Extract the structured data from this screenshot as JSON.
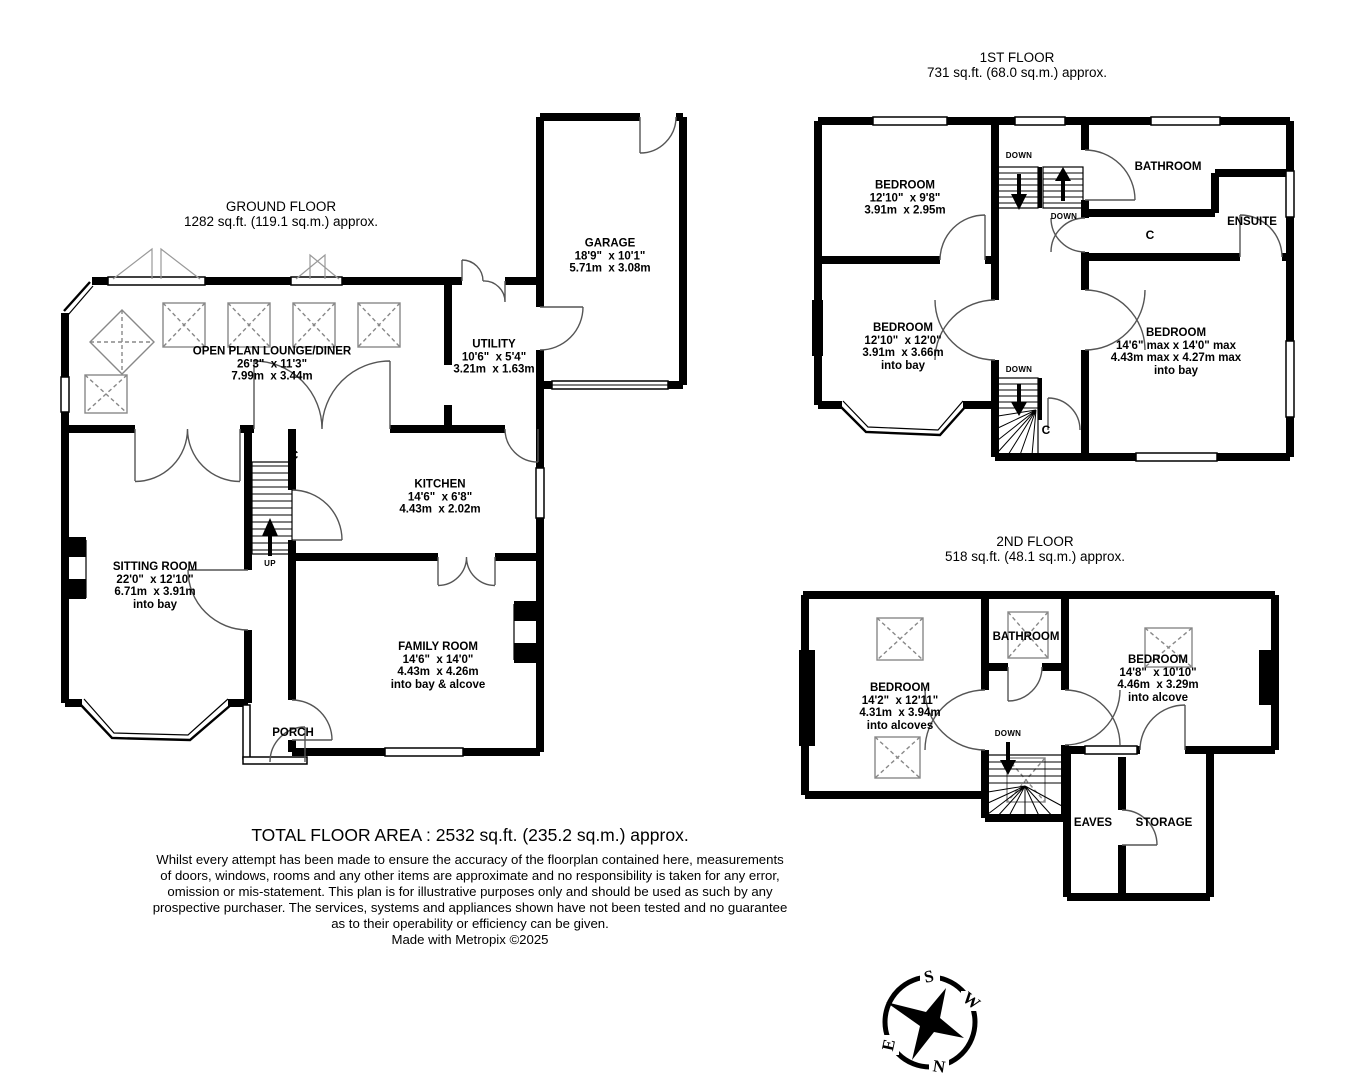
{
  "ground_floor": {
    "title": "GROUND FLOOR",
    "area": "1282 sq.ft. (119.1 sq.m.) approx.",
    "rooms": {
      "lounge": {
        "name": "OPEN PLAN LOUNGE/DINER",
        "imperial": "26'3\"  x 11'3\"",
        "metric": "7.99m  x 3.44m"
      },
      "utility": {
        "name": "UTILITY",
        "imperial": "10'6\"  x 5'4\"",
        "metric": "3.21m  x 1.63m"
      },
      "garage": {
        "name": "GARAGE",
        "imperial": "18'9\"  x 10'1\"",
        "metric": "5.71m  x 3.08m"
      },
      "kitchen": {
        "name": "KITCHEN",
        "imperial": "14'6\"  x 6'8\"",
        "metric": "4.43m  x 2.02m"
      },
      "sitting": {
        "name": "SITTING ROOM",
        "imperial": "22'0\"  x 12'10\"",
        "metric": "6.71m  x 3.91m",
        "note": "into bay"
      },
      "family": {
        "name": "FAMILY ROOM",
        "imperial": "14'6\"  x 14'0\"",
        "metric": "4.43m  x 4.26m",
        "note": "into bay & alcove"
      },
      "porch": {
        "name": "PORCH"
      }
    },
    "labels": {
      "up": "UP",
      "cupboard": "C"
    }
  },
  "first_floor": {
    "title": "1ST FLOOR",
    "area": "731 sq.ft. (68.0 sq.m.) approx.",
    "rooms": {
      "bedroom1": {
        "name": "BEDROOM",
        "imperial": "12'10\"  x 9'8\"",
        "metric": "3.91m  x 2.95m"
      },
      "bedroom2": {
        "name": "BEDROOM",
        "imperial": "12'10\"  x 12'0\"",
        "metric": "3.91m  x 3.66m",
        "note": "into bay"
      },
      "bedroom3": {
        "name": "BEDROOM",
        "imperial": "14'6\" max x 14'0\" max",
        "metric": "4.43m max x 4.27m max",
        "note": "into bay"
      },
      "bathroom": {
        "name": "BATHROOM"
      },
      "ensuite": {
        "name": "ENSUITE"
      }
    },
    "labels": {
      "down": "DOWN",
      "cupboard": "C"
    }
  },
  "second_floor": {
    "title": "2ND FLOOR",
    "area": "518 sq.ft. (48.1 sq.m.) approx.",
    "rooms": {
      "bedroom4": {
        "name": "BEDROOM",
        "imperial": "14'2\"  x 12'11\"",
        "metric": "4.31m  x 3.94m",
        "note": "into alcoves"
      },
      "bedroom5": {
        "name": "BEDROOM",
        "imperial": "14'8\"  x 10'10\"",
        "metric": "4.46m  x 3.29m",
        "note": "into alcove"
      },
      "bathroom": {
        "name": "BATHROOM"
      },
      "eaves": {
        "name": "EAVES"
      },
      "storage": {
        "name": "STORAGE"
      }
    },
    "labels": {
      "down": "DOWN"
    }
  },
  "footer": {
    "total": "TOTAL FLOOR AREA : 2532 sq.ft. (235.2 sq.m.) approx.",
    "disclaimer_lines": [
      "Whilst every attempt has been made to ensure the accuracy of the floorplan contained here, measurements",
      "of doors, windows, rooms and any other items are approximate and no responsibility is taken for any error,",
      "omission or mis-statement. This plan is for illustrative purposes only and should be used as such by any",
      "prospective purchaser. The services, systems and appliances shown have not been tested and no guarantee",
      "as to their operability or efficiency can be given.",
      "Made with Metropix ©2025"
    ]
  },
  "compass": {
    "north": "N",
    "south": "S",
    "east": "E",
    "west": "W"
  },
  "colors": {
    "wall": "#000000",
    "detail": "#555555",
    "skylight": "#888888",
    "background": "#ffffff"
  }
}
